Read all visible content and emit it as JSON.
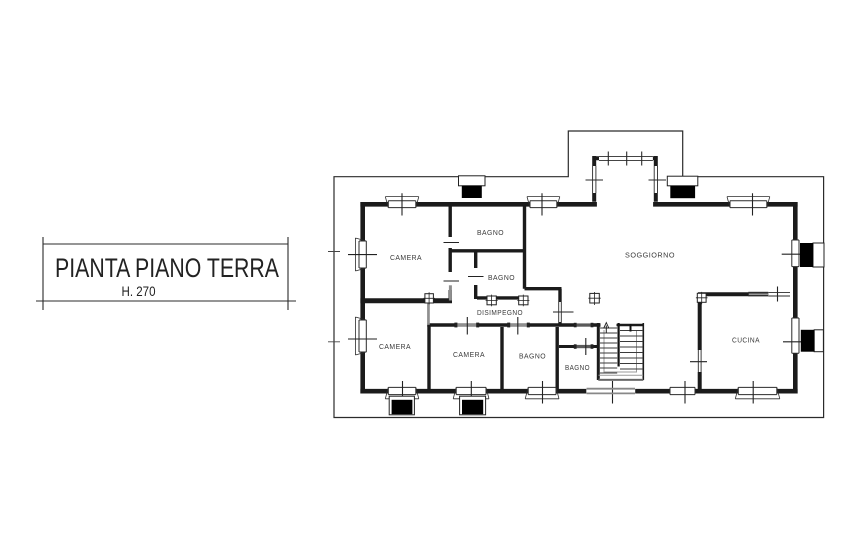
{
  "page": {
    "background": "#ffffff",
    "ink": "#1b1b1b",
    "muted_gray": "#8f8f8f"
  },
  "title_block": {
    "title": "PIANTA PIANO TERRA",
    "height_note": "H. 270"
  },
  "plan": {
    "rooms": [
      {
        "id": "bagno-nord",
        "label": "BAGNO"
      },
      {
        "id": "camera-nord-ovest",
        "label": "CAMERA"
      },
      {
        "id": "soggiorno",
        "label": "SOGGIORNO"
      },
      {
        "id": "bagno-centro",
        "label": "BAGNO"
      },
      {
        "id": "disimpegno",
        "label": "DISIMPEGNO"
      },
      {
        "id": "camera-sud-ovest",
        "label": "CAMERA"
      },
      {
        "id": "camera-sud",
        "label": "CAMERA"
      },
      {
        "id": "bagno-sud",
        "label": "BAGNO"
      },
      {
        "id": "bagno-sud-est",
        "label": "BAGNO"
      },
      {
        "id": "cucina",
        "label": "CUCINA"
      }
    ],
    "stair_direction_icon": "up-arrow"
  }
}
